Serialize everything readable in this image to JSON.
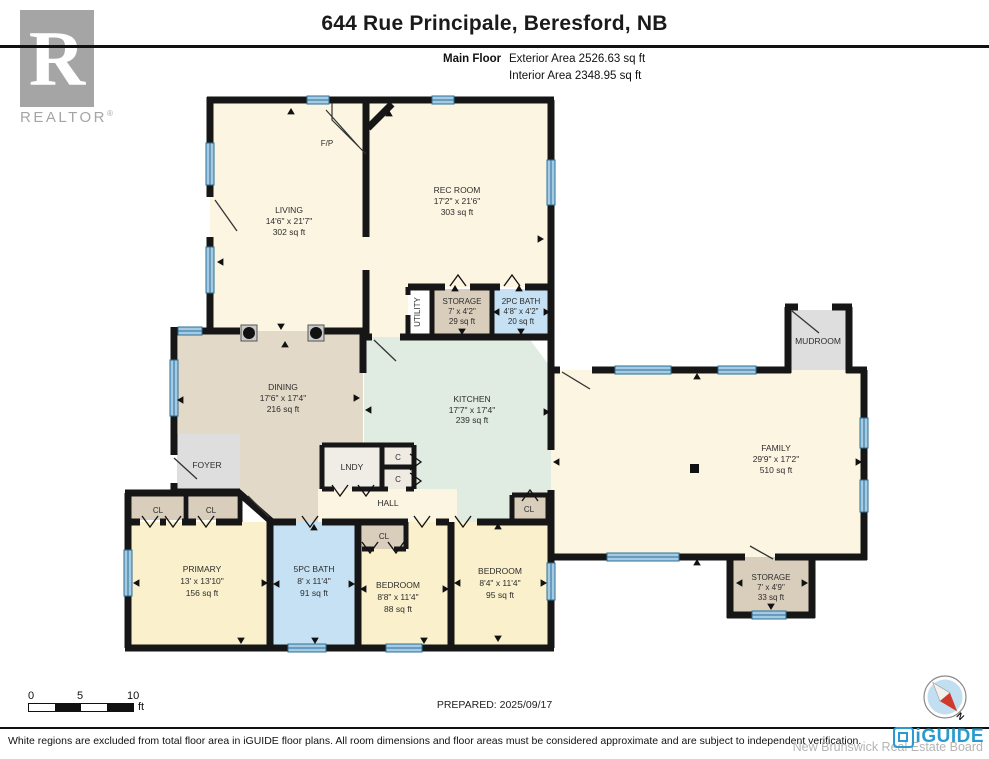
{
  "header": {
    "title": "644 Rue Principale, Beresford, NB",
    "floor_label": "Main Floor",
    "exterior_area": "Exterior Area 2526.63 sq ft",
    "interior_area": "Interior Area 2348.95 sq ft",
    "realtor_r": "R",
    "realtor_word": "REALTOR",
    "realtor_reg": "®"
  },
  "rooms": {
    "living": {
      "name": "LIVING",
      "dims": "14'6\" x 21'7\"",
      "area": "302 sq ft"
    },
    "rec": {
      "name": "REC ROOM",
      "dims": "17'2\" x 21'6\"",
      "area": "303 sq ft"
    },
    "storage_top": {
      "name": "STORAGE",
      "dims": "7' x 4'2\"",
      "area": "29 sq ft"
    },
    "bath2": {
      "name": "2PC BATH",
      "dims": "4'8\" x 4'2\"",
      "area": "20 sq ft"
    },
    "utility": {
      "name": "UTILITY"
    },
    "dining": {
      "name": "DINING",
      "dims": "17'6\" x 17'4\"",
      "area": "216 sq ft"
    },
    "kitchen": {
      "name": "KITCHEN",
      "dims": "17'7\" x 17'4\"",
      "area": "239 sq ft"
    },
    "family": {
      "name": "FAMILY",
      "dims": "29'9\" x 17'2\"",
      "area": "510 sq ft"
    },
    "mudroom": {
      "name": "MUDROOM"
    },
    "storage_right": {
      "name": "STORAGE",
      "dims": "7' x 4'9\"",
      "area": "33 sq ft"
    },
    "foyer": {
      "name": "FOYER"
    },
    "lndy": {
      "name": "LNDY"
    },
    "hall": {
      "name": "HALL"
    },
    "primary": {
      "name": "PRIMARY",
      "dims": "13' x 13'10\"",
      "area": "156 sq ft"
    },
    "bath5": {
      "name": "5PC BATH",
      "dims": "8' x 11'4\"",
      "area": "91 sq ft"
    },
    "bedroom1": {
      "name": "BEDROOM",
      "dims": "8'8\" x 11'4\"",
      "area": "88 sq ft"
    },
    "bedroom2": {
      "name": "BEDROOM",
      "dims": "8'4\" x 11'4\"",
      "area": "95 sq ft"
    },
    "fireplace": {
      "name": "F/P"
    },
    "closet_label": "CL",
    "c_label": "C"
  },
  "scale_bar": {
    "t0": "0",
    "t5": "5",
    "t10": "10",
    "unit": "ft"
  },
  "prepared": "PREPARED: 2025/09/17",
  "footer": {
    "disclaimer": "White regions are excluded from total floor area in iGUIDE floor plans. All room dimensions and floor areas must be considered approximate and are subject to independent verification.",
    "board": "New Brunswick Real Estate Board",
    "brand": "iGUIDE",
    "compass_n": "N"
  },
  "colors": {
    "cream": "#FCF5E2",
    "tan": "#E3D9C8",
    "closet_tan": "#D9CDBC",
    "mint": "#E0EBE2",
    "bath_blue": "#C6E1F4",
    "bedroom_yellow": "#FAF0CC",
    "gray_room": "#DEDEDE",
    "wall": "#161616",
    "window_blue": "#A5CBE4",
    "iguide_blue": "#2A9BD0"
  }
}
